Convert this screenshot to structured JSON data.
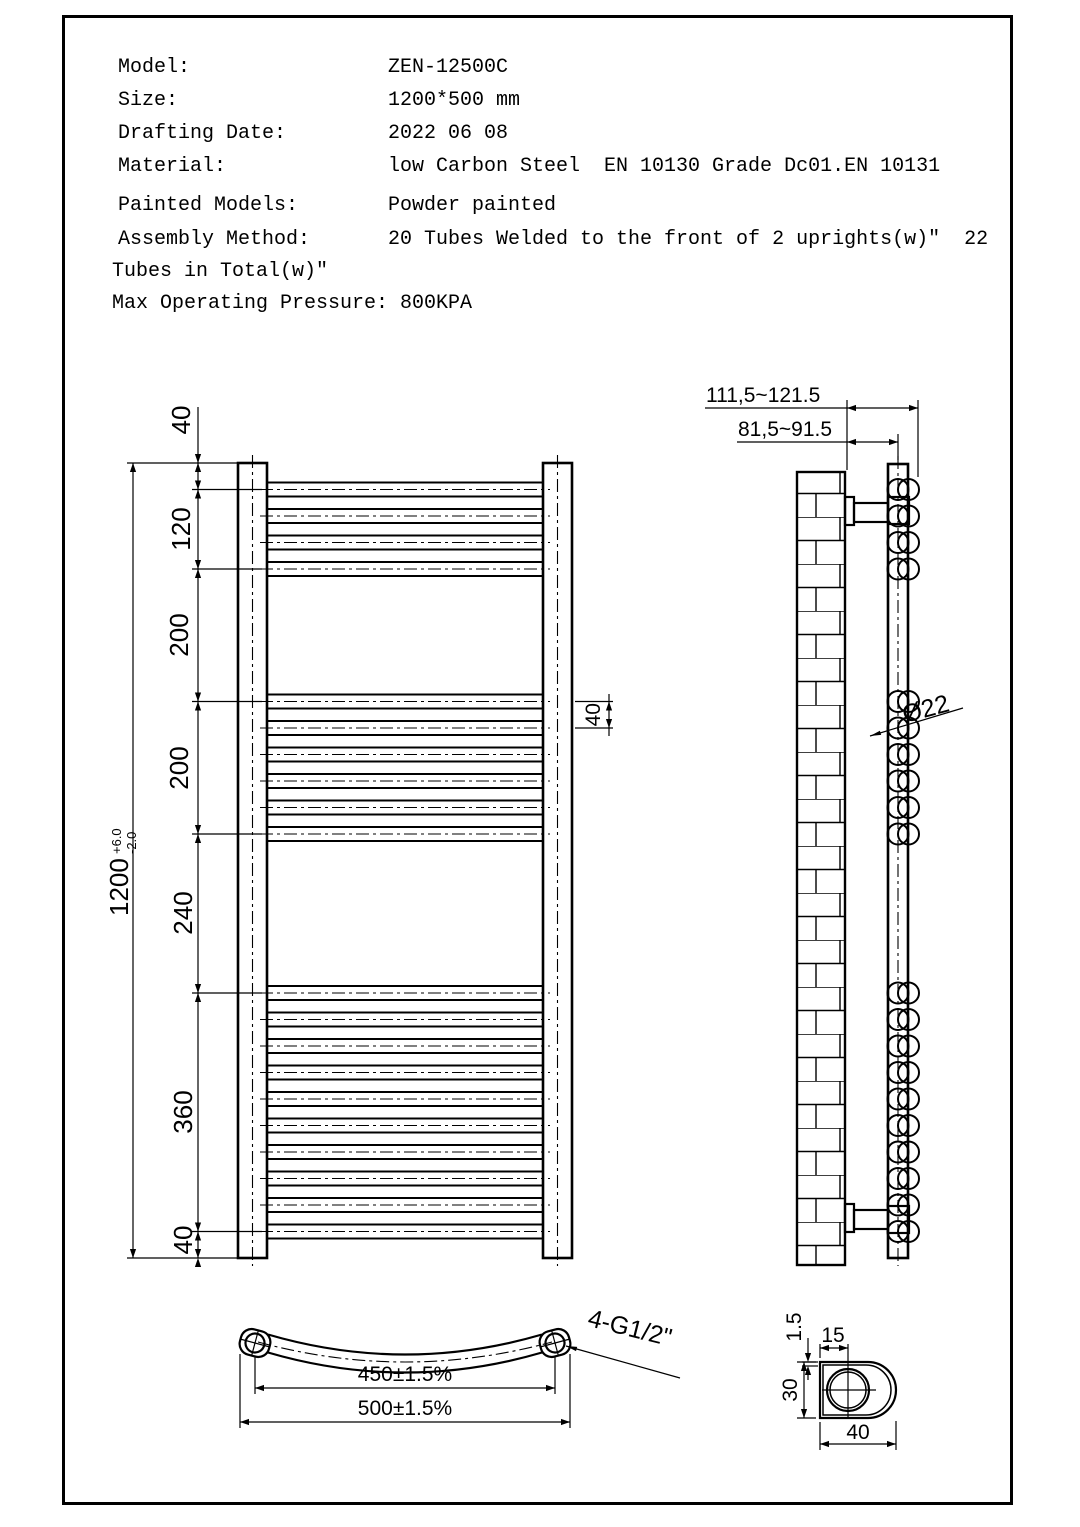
{
  "header": {
    "rows": [
      {
        "label": "Model:",
        "value": "ZEN-12500C"
      },
      {
        "label": "Size:",
        "value": "1200*500 mm"
      },
      {
        "label": "Drafting Date:",
        "value": "2022 06 08"
      },
      {
        "label": "Material:",
        "value": "low Carbon Steel  EN 10130 Grade Dc01.EN 10131"
      },
      {
        "label": "Painted Models:",
        "value": "Powder painted"
      },
      {
        "label": "Assembly Method:",
        "value": "20 Tubes Welded to the front of 2 uprights(w)\"  22"
      }
    ],
    "continuation": "Tubes in Total(w)\"",
    "pressure": "Max Operating Pressure: 800KPA"
  },
  "front_view": {
    "dim_top_gap": "40",
    "dim_group1": "120",
    "dim_gap1": "200",
    "dim_group2": "200",
    "dim_gap2": "240",
    "dim_group3": "360",
    "dim_bottom_gap": "40",
    "overall_height": "1200",
    "tolerance_plus": "+6.0",
    "tolerance_minus": "-2.0",
    "tube_pitch": "40"
  },
  "side_view": {
    "wall_to_front": "111,5~121.5",
    "wall_to_center": "81,5~91.5",
    "tube_diameter": "Ø22"
  },
  "bottom_view": {
    "center_distance": "450±1.5%",
    "overall_width": "500±1.5%",
    "thread_spec": "4-G1/2\""
  },
  "detail_view": {
    "wall_thickness": "1.5",
    "hole_offset": "15",
    "profile_width": "30",
    "profile_depth": "40"
  }
}
